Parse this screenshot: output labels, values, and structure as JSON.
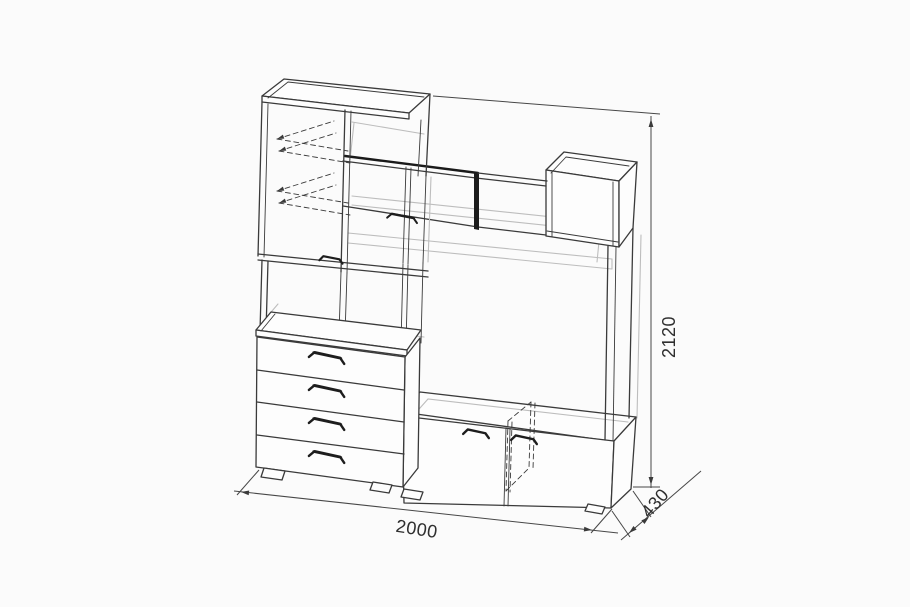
{
  "dimensions": {
    "width": {
      "label": "2000"
    },
    "depth": {
      "label": "430"
    },
    "height": {
      "label": "2120"
    }
  },
  "colors": {
    "background": "#fbfbfb",
    "line_main": "#3a3a3a",
    "line_light": "#bdbdbd",
    "line_heavy": "#1a1a1a",
    "dimension_text": "#2f2f2f"
  }
}
